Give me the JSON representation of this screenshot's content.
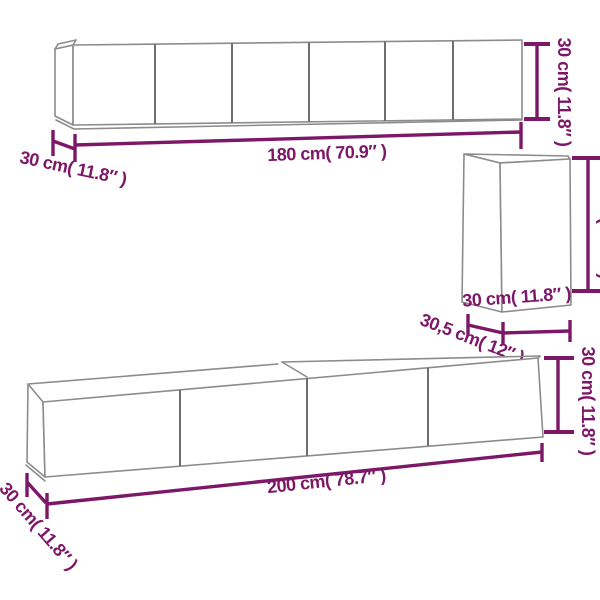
{
  "colors": {
    "dimension": "#7d1767",
    "outline": "#8c8c8c",
    "panel_line": "#6e6e6e",
    "background": "#ffffff"
  },
  "cabinets": {
    "top_wall_cabinet": {
      "door_count": 6,
      "width_label": "180 cm( 70.9″ )",
      "height_label": "30 cm( 11.8″ )",
      "depth_label": "30 cm( 11.8″ )"
    },
    "side_wall_cabinet": {
      "door_count": 1,
      "width_label": "30 cm( 11.8″ )",
      "height_label": "60 cm( 23.6″ )",
      "depth_label": "30,5 cm( 12″ )"
    },
    "tv_bench": {
      "door_count": 4,
      "width_label": "200 cm( 78.7″ )",
      "height_label": "30 cm( 11.8″ )",
      "depth_label": "30 cm( 11.8″ )"
    }
  }
}
